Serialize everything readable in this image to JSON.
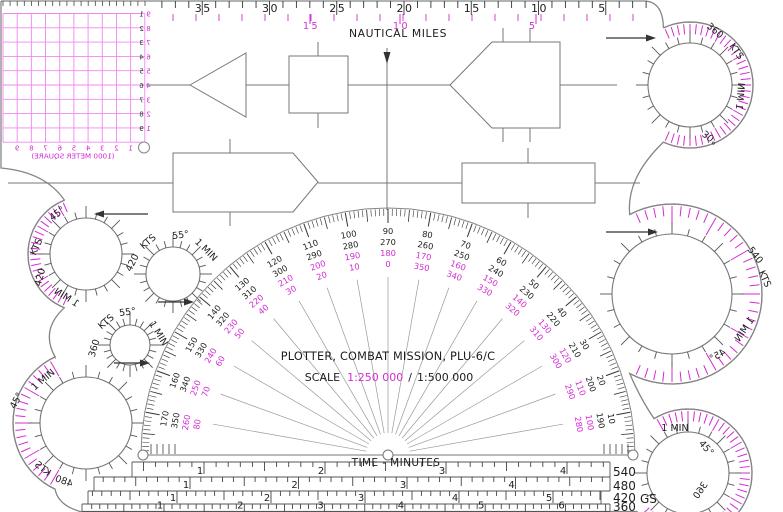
{
  "title": "PLOTTER, COMBAT MISSION, PLU-6/C",
  "scale": {
    "label": "SCALE",
    "primary": "1:250 000",
    "separator": "/",
    "secondary": "1:500 000"
  },
  "top_ruler": {
    "caption": "NAUTICAL MILES",
    "black_labels": [
      "35",
      "30",
      "25",
      "20",
      "15",
      "10",
      "5"
    ],
    "magenta_labels": [
      {
        "t": "15",
        "x": 310
      },
      {
        "t": "10",
        "x": 400
      },
      {
        "t": "5",
        "x": 536
      }
    ]
  },
  "grid": {
    "caption": "(1000 METER SQUARE)",
    "right_black": [
      "1",
      "2",
      "3",
      "4",
      "5",
      "6",
      "7",
      "8",
      "9"
    ],
    "right_magenta": [
      "9",
      "8",
      "7",
      "6",
      "5",
      "4",
      "3",
      "2",
      "1"
    ],
    "bottom": [
      "1",
      "2",
      "3",
      "4",
      "5",
      "6",
      "7",
      "8",
      "9"
    ]
  },
  "protractor": {
    "rays": [
      {
        "deg": 170,
        "labels": [
          "170",
          "350",
          "260",
          "80"
        ]
      },
      {
        "deg": 160,
        "labels": [
          "160",
          "340",
          "250",
          "70"
        ]
      },
      {
        "deg": 150,
        "labels": [
          "150",
          "330",
          "240",
          "60"
        ]
      },
      {
        "deg": 140,
        "labels": [
          "140",
          "320",
          "230",
          "50"
        ]
      },
      {
        "deg": 130,
        "labels": [
          "130",
          "310",
          "220",
          "40"
        ]
      },
      {
        "deg": 120,
        "labels": [
          "120",
          "300",
          "210",
          "30"
        ]
      },
      {
        "deg": 110,
        "labels": [
          "110",
          "290",
          "200",
          "20"
        ]
      },
      {
        "deg": 100,
        "labels": [
          "100",
          "280",
          "190",
          "10"
        ]
      },
      {
        "deg": 90,
        "labels": [
          "90",
          "270",
          "180",
          "0"
        ]
      },
      {
        "deg": 80,
        "labels": [
          "80",
          "260",
          "170",
          "350"
        ]
      },
      {
        "deg": 70,
        "labels": [
          "70",
          "250",
          "160",
          "340"
        ]
      },
      {
        "deg": 60,
        "labels": [
          "60",
          "240",
          "150",
          "330"
        ]
      },
      {
        "deg": 50,
        "labels": [
          "50",
          "230",
          "140",
          "320"
        ]
      },
      {
        "deg": 40,
        "labels": [
          "40",
          "220",
          "130",
          "310"
        ]
      },
      {
        "deg": 30,
        "labels": [
          "30",
          "210",
          "120",
          "300"
        ]
      },
      {
        "deg": 20,
        "labels": [
          "20",
          "200",
          "110",
          "290"
        ]
      },
      {
        "deg": 10,
        "labels": [
          "10",
          "190",
          "100",
          "280"
        ]
      }
    ]
  },
  "speed_circles": [
    {
      "name": "speed-circle-360-top",
      "cx": 690,
      "cy": 85,
      "r": 42,
      "R": 63,
      "arc": [
        -115,
        115
      ],
      "arrow": [
        606,
        38,
        646,
        38
      ],
      "labels": [
        {
          "t": "360",
          "x": 713,
          "y": 33,
          "rot": 40
        },
        {
          "t": "KTS",
          "x": 734,
          "y": 53,
          "rot": 55
        },
        {
          "t": "1 MIN",
          "x": 737,
          "y": 96,
          "rot": 95,
          "flip": true
        },
        {
          "t": "30°",
          "x": 712,
          "y": 135,
          "rot": -142,
          "flip": true
        }
      ]
    },
    {
      "name": "speed-circle-420-left",
      "cx": 86,
      "cy": 254,
      "r": 36,
      "R": 58,
      "arc": [
        112,
        248
      ],
      "arrow": [
        148,
        214,
        104,
        214
      ],
      "labels": [
        {
          "t": "45°",
          "x": 59,
          "y": 216,
          "rot": -38
        },
        {
          "t": "KTS",
          "x": 39,
          "y": 248,
          "rot": -66
        },
        {
          "t": "420",
          "x": 43,
          "y": 278,
          "rot": -76
        },
        {
          "t": "1 MIN",
          "x": 65,
          "y": 300,
          "rot": 32,
          "flip": true
        }
      ]
    },
    {
      "name": "speed-circle-420-mid",
      "cx": 173,
      "cy": 274,
      "r": 27,
      "arrow": [
        158,
        302,
        184,
        302
      ],
      "labels": [
        {
          "t": "420",
          "x": 135,
          "y": 264,
          "rot": -64
        },
        {
          "t": "KTS",
          "x": 150,
          "y": 244,
          "rot": -40
        },
        {
          "t": "55°",
          "x": 181,
          "y": 238,
          "rot": -8
        },
        {
          "t": "1 MIN",
          "x": 204,
          "y": 252,
          "rot": 45
        }
      ]
    },
    {
      "name": "speed-circle-360-mid",
      "cx": 130,
      "cy": 345,
      "r": 20,
      "arrow": [
        114,
        363,
        140,
        363
      ],
      "labels": [
        {
          "t": "55°",
          "x": 128,
          "y": 315,
          "rot": -8
        },
        {
          "t": "KTS",
          "x": 108,
          "y": 324,
          "rot": -40
        },
        {
          "t": "360",
          "x": 97,
          "y": 349,
          "rot": -74
        },
        {
          "t": "1 MIN",
          "x": 156,
          "y": 335,
          "rot": 58
        }
      ]
    },
    {
      "name": "speed-circle-480",
      "cx": 86,
      "cy": 423,
      "r": 46,
      "R": 73,
      "arc": [
        115,
        245
      ],
      "labels": [
        {
          "t": "1 MIN",
          "x": 45,
          "y": 382,
          "rot": -40
        },
        {
          "t": "45°",
          "x": 19,
          "y": 402,
          "rot": -62
        },
        {
          "t": "KTS",
          "x": 41,
          "y": 471,
          "rot": 38,
          "flip": true
        },
        {
          "t": "480",
          "x": 63,
          "y": 484,
          "rot": 20,
          "flip": true
        }
      ]
    },
    {
      "name": "speed-circle-540",
      "cx": 672,
      "cy": 294,
      "r": 60,
      "R": 90,
      "arc": [
        -118,
        118
      ],
      "arrow": [
        606,
        232,
        648,
        232
      ],
      "labels": [
        {
          "t": "540",
          "x": 753,
          "y": 257,
          "rot": 52
        },
        {
          "t": "KTS",
          "x": 762,
          "y": 280,
          "rot": 66
        },
        {
          "t": "1 MIN",
          "x": 747,
          "y": 331,
          "rot": -56,
          "flip": true
        },
        {
          "t": "45°",
          "x": 719,
          "y": 358,
          "rot": -28,
          "flip": true
        }
      ]
    },
    {
      "name": "speed-circle-360-bottom",
      "cx": 688,
      "cy": 473,
      "r": 41,
      "R": 64,
      "arc": [
        -143,
        122
      ],
      "labels": [
        {
          "t": "1 MIN",
          "x": 675,
          "y": 431,
          "rot": 0
        },
        {
          "t": "45°",
          "x": 704,
          "y": 450,
          "rot": 48
        },
        {
          "t": "360",
          "x": 703,
          "y": 492,
          "rot": -56,
          "flip": true
        }
      ]
    }
  ],
  "time_scales": {
    "caption": "TIME - MINUTES",
    "gs": "GS",
    "rows": [
      {
        "speed": "540",
        "numbers": [
          "1",
          "2",
          "3",
          "4"
        ],
        "x1": 204,
        "dx": 121,
        "y_top": 462,
        "y_bot": 477,
        "x_start": 132,
        "x_end": 610
      },
      {
        "speed": "480",
        "numbers": [
          "1",
          "2",
          "3",
          "4"
        ],
        "x1": 190,
        "dx": 108.5,
        "y_top": 477,
        "y_bot": 491,
        "x_start": 94,
        "x_end": 610
      },
      {
        "speed": "420",
        "numbers": [
          "1",
          "2",
          "3",
          "4",
          "5"
        ],
        "x1": 177,
        "dx": 94,
        "y_top": 491,
        "y_bot": 504,
        "x_start": 88,
        "x_end": 601
      },
      {
        "speed": "360",
        "numbers": [
          "1",
          "2",
          "3",
          "4",
          "5",
          "6"
        ],
        "x1": 164,
        "dx": 80.3,
        "y_top": 504,
        "y_bot": 511.5,
        "x_start": 82,
        "x_end": 610
      }
    ]
  },
  "colors": {
    "ink": "#1d1d1d",
    "magenta": "#d32bd3",
    "grid_pink": "#f087f0",
    "edge": "#858585"
  }
}
